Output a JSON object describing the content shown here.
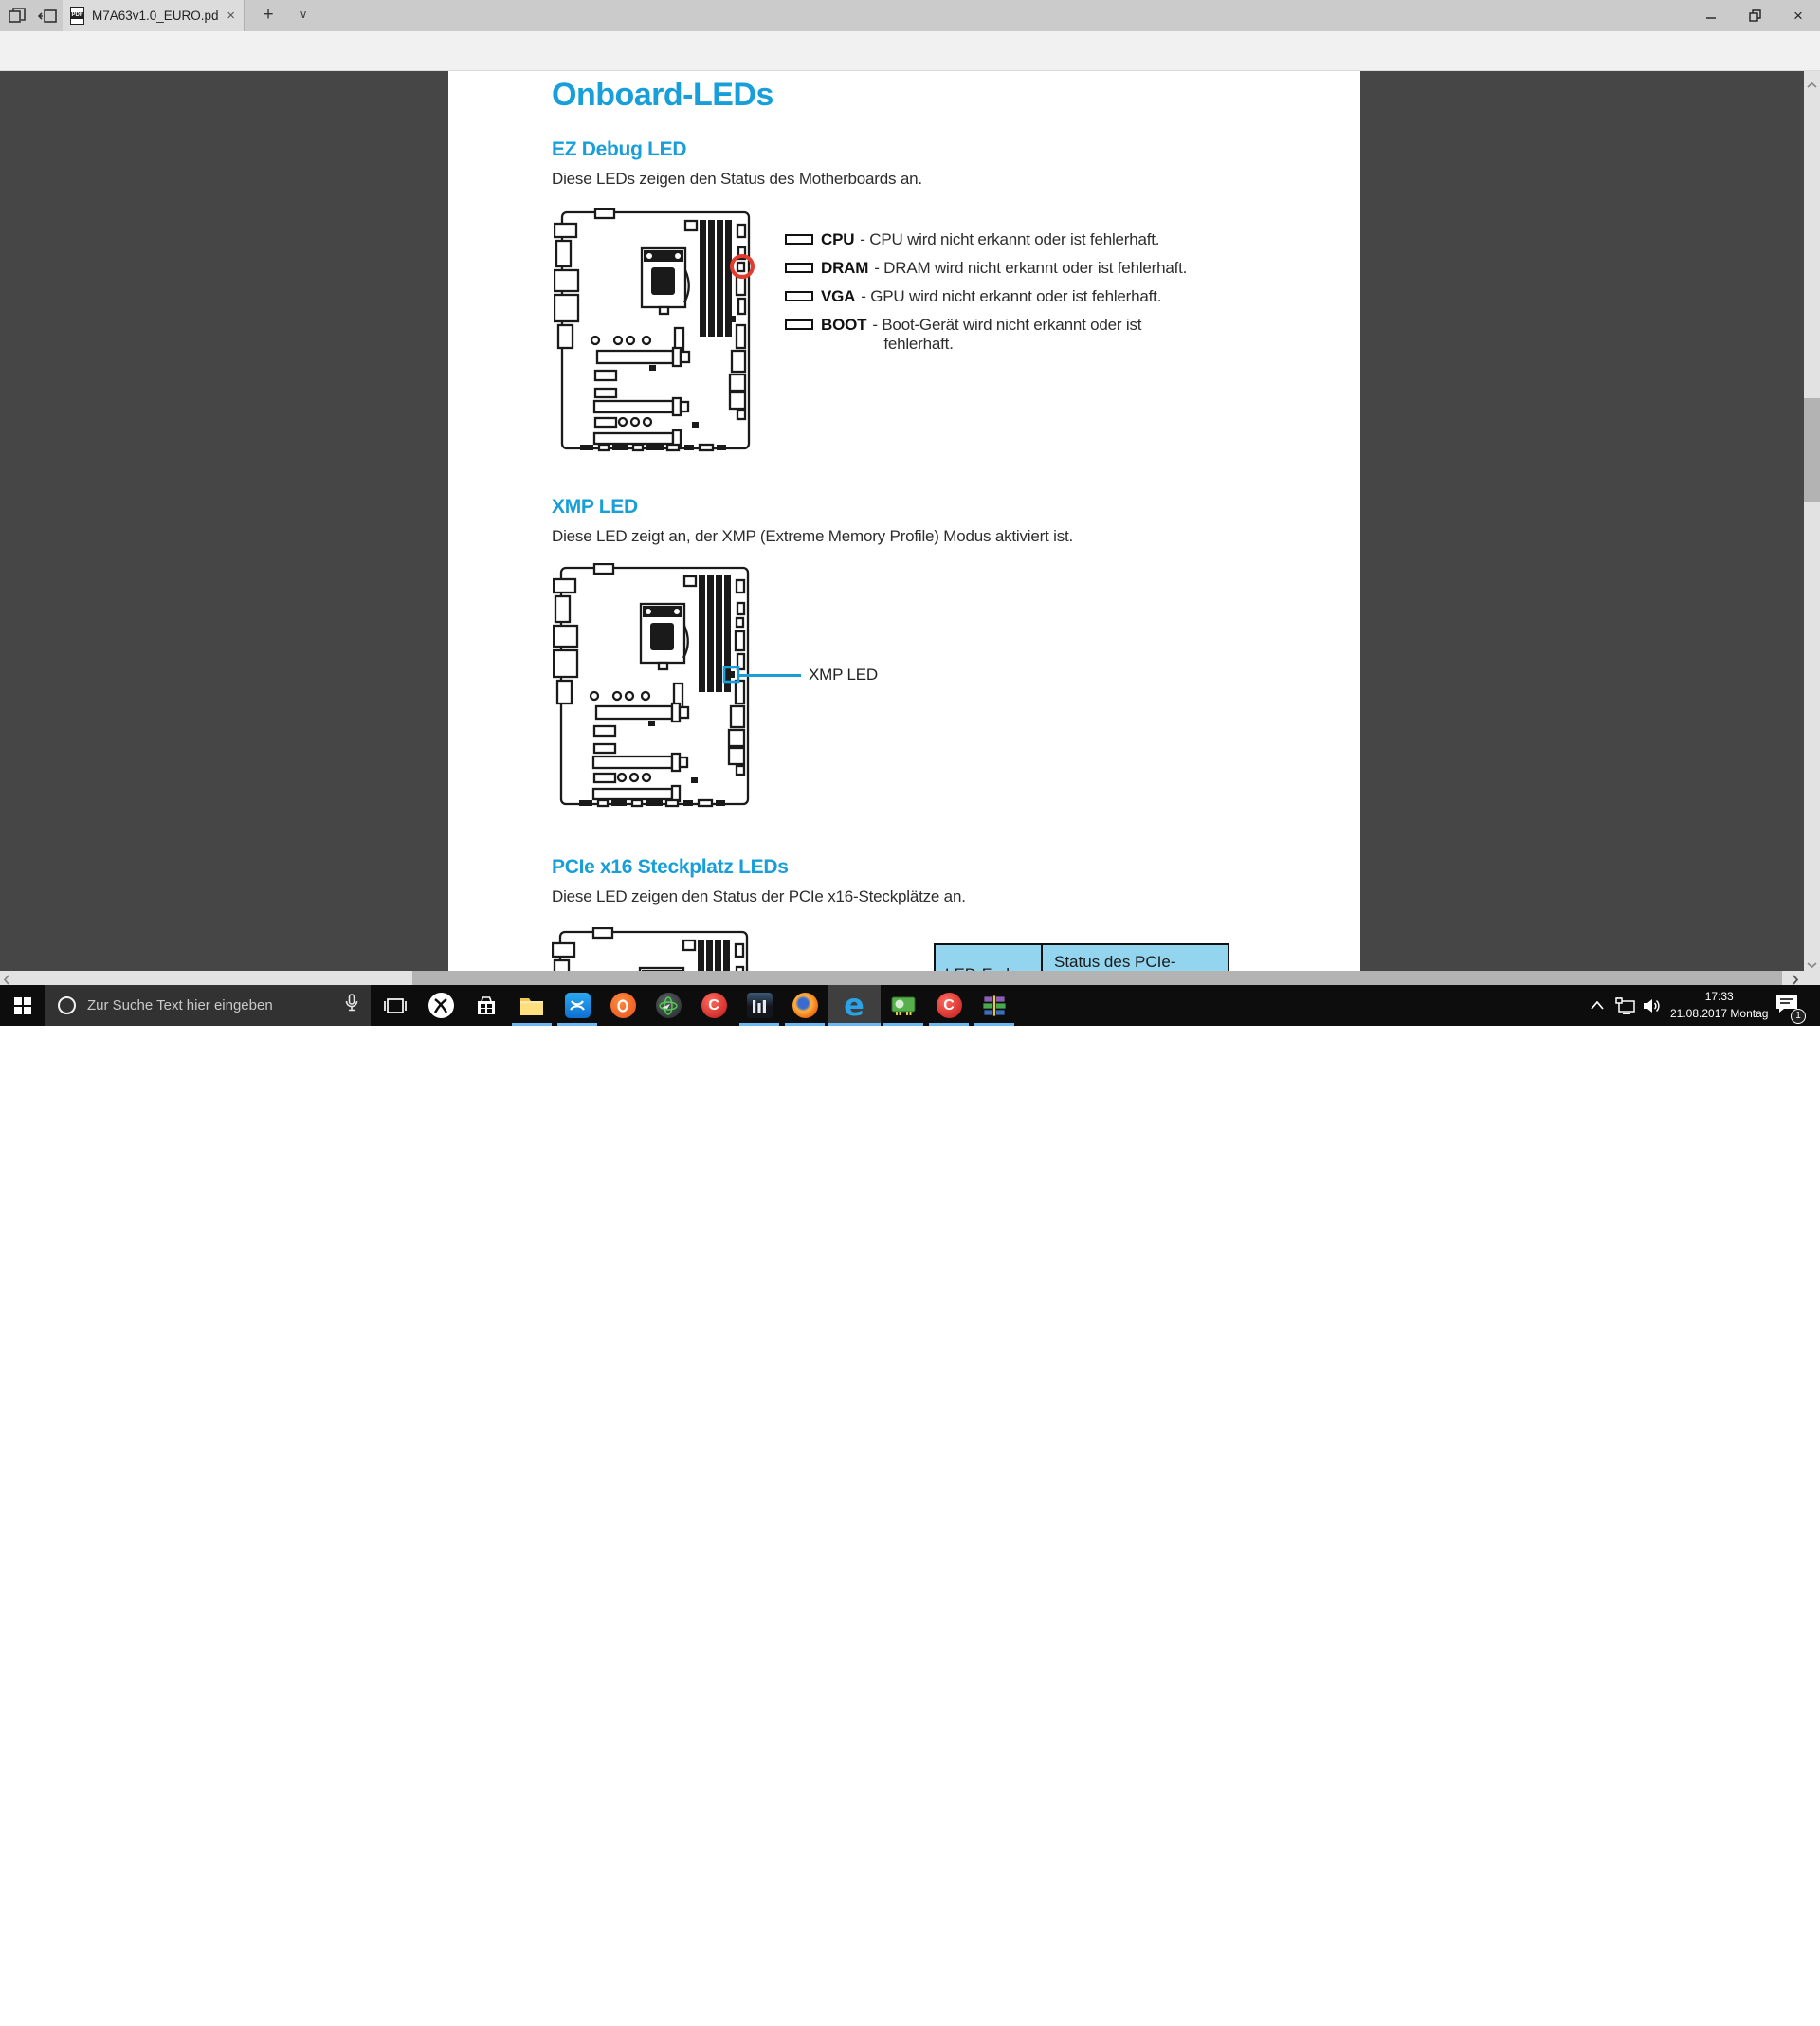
{
  "colors": {
    "accent_blue": "#189ed9",
    "highlight_red": "#e23c2e",
    "table_header_blue": "#93d4ee",
    "taskbar_underline_blue": "#6cb8f0",
    "pdf_background": "#464646"
  },
  "glyphs": {
    "back": "←",
    "forward": "→",
    "refresh": "↻",
    "new_tab": "+",
    "tab_dropdown": "∨",
    "tab_close": "×",
    "star": "☆",
    "pen": "✎",
    "ellipsis": "•••",
    "close_window": "×"
  },
  "browser": {
    "tab_title": "M7A63v1.0_EURO.pdf",
    "favicon_label": "PDF",
    "url": "file:///C:/Users/XTREME~1/AppData/Local/Temp/Rar$DIa0.712/M7A63v1.0_EURO.pdf"
  },
  "pdf": {
    "title": "Onboard-LEDs",
    "ez_debug": {
      "heading": "EZ Debug LED",
      "body": "Diese LEDs zeigen den Status des Motherboards an.",
      "legend": [
        {
          "label": "CPU",
          "desc": "- CPU wird nicht erkannt oder ist fehlerhaft.",
          "desc2": ""
        },
        {
          "label": "DRAM",
          "desc": "- DRAM wird nicht erkannt oder ist fehlerhaft.",
          "desc2": ""
        },
        {
          "label": "VGA",
          "desc": "- GPU wird nicht erkannt oder ist fehlerhaft.",
          "desc2": ""
        },
        {
          "label": "BOOT",
          "desc": "- Boot-Gerät wird nicht erkannt oder ist",
          "desc2": "fehlerhaft."
        }
      ]
    },
    "xmp": {
      "heading": "XMP LED",
      "body": "Diese LED zeigt an, der XMP (Extreme Memory Profile) Modus aktiviert ist.",
      "callout": "XMP LED"
    },
    "pcie": {
      "heading": "PCIe x16 Steckplatz LEDs",
      "body": "Diese LED zeigen den Status der PCIe x16-Steckplätze an.",
      "table": {
        "col1": "LED-Farbe",
        "col2": "Status des PCIe-"
      }
    }
  },
  "taskbar": {
    "search_placeholder": "Zur Suche Text hier eingeben",
    "apps": [
      "task-view",
      "xbox",
      "microsoft-store",
      "file-explorer",
      "uplay",
      "origin",
      "globe-utility",
      "ccleaner",
      "stripes-app",
      "firefox",
      "edge",
      "device-manager",
      "ccleaner-2",
      "winrar"
    ],
    "tray": {
      "time": "17:33",
      "date": "21.08.2017 Montag",
      "notification_badge": "1"
    }
  }
}
